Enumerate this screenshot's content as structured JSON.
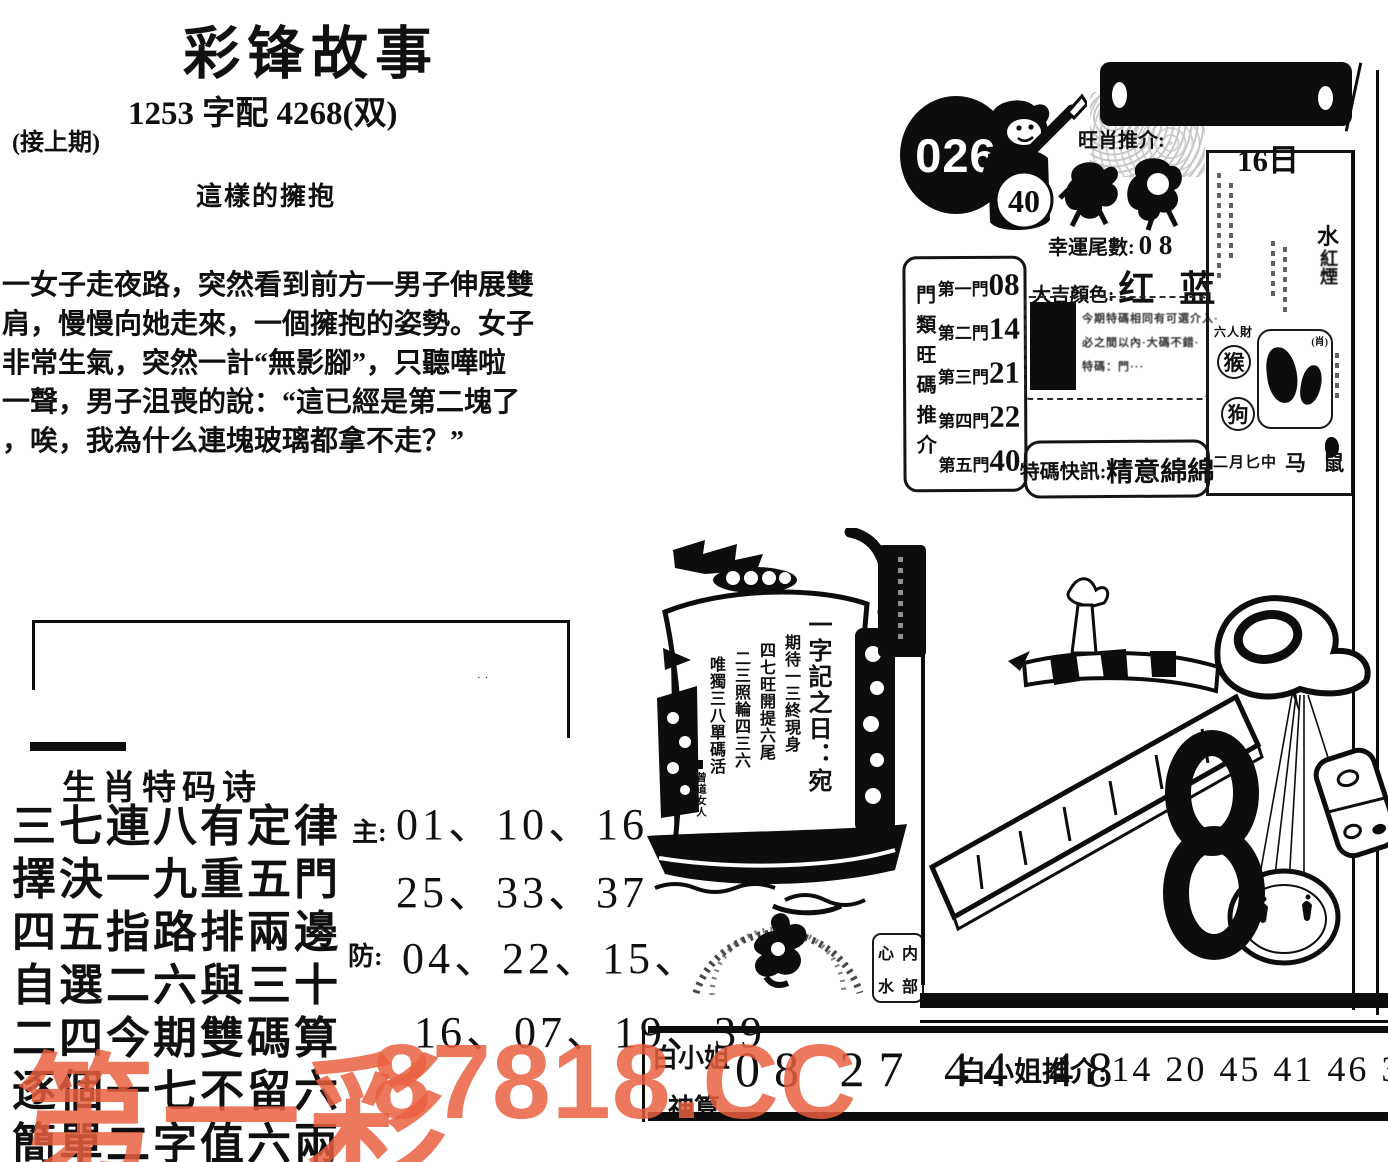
{
  "header": {
    "title": "彩锋故事",
    "subtitle": "1253 字配 4268(双)",
    "continued": "(接上期)",
    "story_title": "這樣的擁抱",
    "story_lines": [
      "一女子走夜路，突然看到前方一男子伸展雙",
      "肩，慢慢向她走來，一個擁抱的姿勢。女子",
      "非常生氣，突然一計“無影腳”，只聽嘩啦",
      "一聲，男子沮喪的說：“這已經是第二塊了",
      "，唉，我為什么連塊玻璃都拿不走？”"
    ]
  },
  "issue_panel": {
    "issue_number": "026",
    "boy_number": "40",
    "wang_xiao_label": "旺肖推介:",
    "lucky_tail_label": "幸運尾數:",
    "lucky_tail_value": "0 8",
    "lucky_color_label": "大吉顏色:",
    "lucky_color_value": "红 蓝",
    "gate_box": {
      "side_label": "門類旺碼推介",
      "rows": [
        {
          "gate": "第一門",
          "num": "08"
        },
        {
          "gate": "第二門",
          "num": "14"
        },
        {
          "gate": "第三門",
          "num": "21"
        },
        {
          "gate": "第四門",
          "num": "22"
        },
        {
          "gate": "第五門",
          "num": "40"
        }
      ]
    },
    "note_lines": [
      "今期特碼相同有可選介入·",
      "必之間以內·大碼不錯·",
      "特碼：門···"
    ],
    "flash_label": "特碼快訊:",
    "flash_value": "精意綿綿",
    "almanac": {
      "date": "16日",
      "element": "水",
      "right_col": "紅煙",
      "people": "六人財",
      "zodiac1": "猴",
      "zodiac2": "狗",
      "xiao_mark": "(肖)",
      "bottom_left": "二月匕中",
      "bottom_right": "马 鼠"
    }
  },
  "ship": {
    "headline": "一字記之日：宛",
    "verse": [
      "期待一三終現身",
      "四七旺開提六尾",
      "二三照輪四三六",
      "唯獨三八單碼活"
    ],
    "signature": "曾道女人"
  },
  "seal": {
    "chars": [
      "心",
      "内",
      "水",
      "部"
    ]
  },
  "poem": {
    "title": "生肖特码诗",
    "lines": [
      "三七連八有定律",
      "擇決一九重五門",
      "四五指路排兩邊",
      "自選二六與三十",
      "二四今期雙碼算",
      "逐個一七不留六",
      "簡單二字值六兩"
    ]
  },
  "picks": {
    "main_label": "主:",
    "main_line1": "01、10、16",
    "main_line2": "25、33、37",
    "guard_label": "防:",
    "guard_line1": "04、22、15、",
    "guard_line2": "16、07、19、39"
  },
  "footer": {
    "name_top": "白小姐",
    "name_bottom": "神算",
    "numbers": "08 27 44 48",
    "tuijie_label": "白小姐推介:",
    "tuijie_numbers": "14 20 45 41 46 30"
  },
  "watermark": {
    "text_cn": "第一彩",
    "text_code": "87818.CC",
    "color": "#e95f40"
  }
}
